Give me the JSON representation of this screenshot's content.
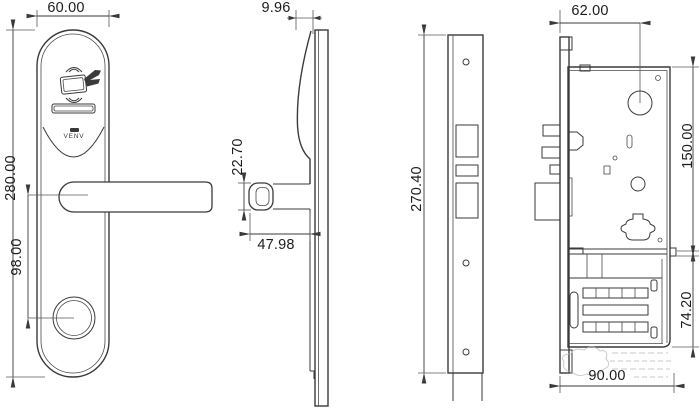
{
  "drawing": {
    "title": "smart-lock technical drawing",
    "dimensions": {
      "front_width": "60.00",
      "front_height": "280.00",
      "handle_to_cylinder": "98.00",
      "cover_thickness": "9.96",
      "handle_section": "22.70",
      "handle_length": "47.98",
      "faceplate_height": "270.40",
      "spindle_offset": "62.00",
      "case_height": "150.00",
      "module_height": "74.20",
      "case_depth": "90.00"
    },
    "brand": {
      "logo_text": "VENV"
    },
    "colors": {
      "line": "#3a3a3a",
      "background": "#ffffff",
      "watermark": "#b9b9b9"
    }
  }
}
